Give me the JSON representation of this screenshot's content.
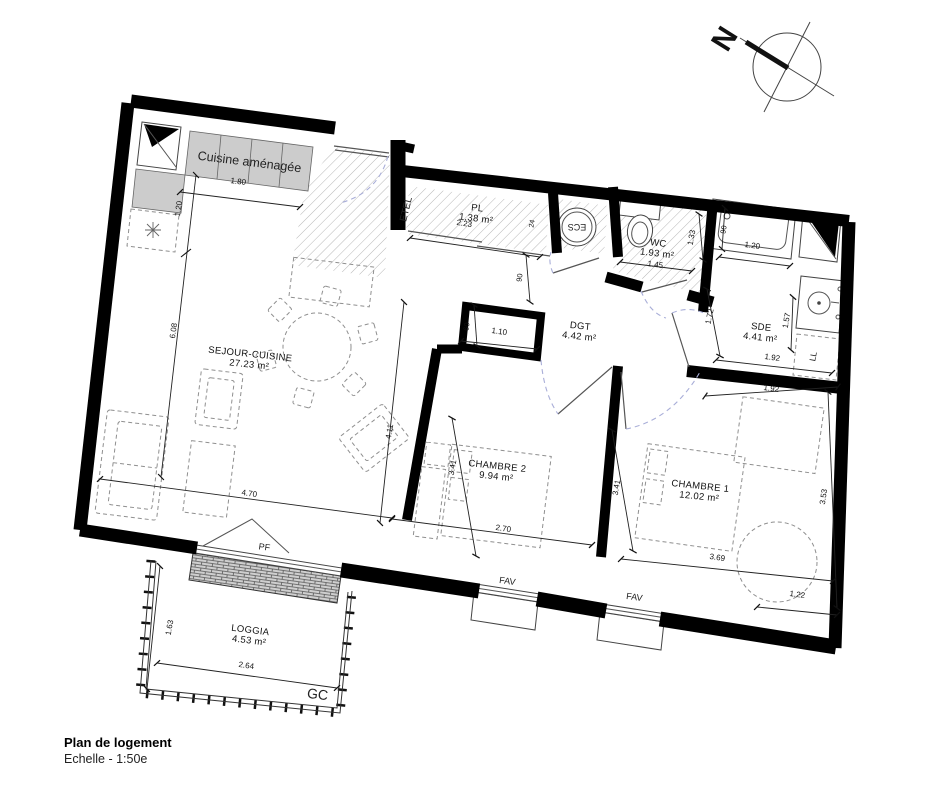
{
  "page": {
    "title": "Plan de logement",
    "scale": "Echelle - 1:50e"
  },
  "compass": {
    "north_label": "N"
  },
  "colors": {
    "wall": "#000000",
    "counter": "#cccccc",
    "hatch": "#9c9c9c",
    "furniture_dash": "#8f8f8f",
    "door_arc": "#a9aed8",
    "text": "#111111"
  },
  "rooms": [
    {
      "name": "SEJOUR-CUISINE",
      "area": "27.23 m²",
      "x": 250,
      "y": 357,
      "rot": 6
    },
    {
      "name": "CHAMBRE 2",
      "area": "9.94 m²",
      "x": 497,
      "y": 469,
      "rot": 6
    },
    {
      "name": "CHAMBRE 1",
      "area": "12.02 m²",
      "x": 700,
      "y": 489,
      "rot": 6
    },
    {
      "name": "DGT",
      "area": "4.42 m²",
      "x": 580,
      "y": 329,
      "rot": 6
    },
    {
      "name": "PL",
      "area": "1.38 m²",
      "x": 477,
      "y": 211,
      "rot": 7
    },
    {
      "name": "WC",
      "area": "1.93 m²",
      "x": 658,
      "y": 246,
      "rot": 7
    },
    {
      "name": "SDE",
      "area": "4.41 m²",
      "x": 761,
      "y": 330,
      "rot": 6
    },
    {
      "name": "LOGGIA",
      "area": "4.53 m²",
      "x": 250,
      "y": 633,
      "rot": 7
    }
  ],
  "annotations": [
    {
      "id": "kitchen-label",
      "text": "Cuisine aménagée",
      "x": 249,
      "y": 166,
      "rot": 7,
      "fs": 12.5
    },
    {
      "id": "etel-label",
      "text": "ETEL",
      "x": 409,
      "y": 210,
      "rot": -76,
      "fs": 10
    },
    {
      "id": "ecs-label",
      "text": "ECS",
      "x": 577,
      "y": 224,
      "rot": 180,
      "fs": 9
    },
    {
      "id": "pf-label",
      "text": "PF",
      "x": 264,
      "y": 550,
      "rot": 8,
      "fs": 9
    },
    {
      "id": "fav-label-1",
      "text": "FAV",
      "x": 507,
      "y": 584,
      "rot": 8,
      "fs": 9
    },
    {
      "id": "fav-label-2",
      "text": "FAV",
      "x": 634,
      "y": 600,
      "rot": 8,
      "fs": 9
    },
    {
      "id": "gc-label",
      "text": "GC",
      "x": 317,
      "y": 699,
      "rot": 7,
      "fs": 14
    },
    {
      "id": "ll-label",
      "text": "LL",
      "x": 816,
      "y": 357,
      "rot": -80,
      "fs": 8.5
    }
  ],
  "dimensions": [
    {
      "text": "1.80",
      "x": 238,
      "y": 184,
      "rot": 7
    },
    {
      "text": "1.20",
      "x": 181,
      "y": 209,
      "rot": -82
    },
    {
      "text": "6.08",
      "x": 176,
      "y": 331,
      "rot": -82
    },
    {
      "text": "4.70",
      "x": 249,
      "y": 496,
      "rot": 8
    },
    {
      "text": "4.11",
      "x": 392,
      "y": 432,
      "rot": -80
    },
    {
      "text": "2.23",
      "x": 464,
      "y": 226,
      "rot": 8
    },
    {
      "text": "24",
      "x": 534,
      "y": 224,
      "rot": -80,
      "fs": 7
    },
    {
      "text": "90",
      "x": 522,
      "y": 278,
      "rot": -82,
      "fs": 7.5
    },
    {
      "text": "60",
      "x": 469,
      "y": 327,
      "rot": -82,
      "fs": 7.5
    },
    {
      "text": "1.10",
      "x": 499,
      "y": 334,
      "rot": 8
    },
    {
      "text": "3.41",
      "x": 455,
      "y": 468,
      "rot": -80
    },
    {
      "text": "2.70",
      "x": 503,
      "y": 531,
      "rot": 8
    },
    {
      "text": "1.45",
      "x": 655,
      "y": 267,
      "rot": 8
    },
    {
      "text": "1.33",
      "x": 694,
      "y": 238,
      "rot": -80
    },
    {
      "text": "1.20",
      "x": 752,
      "y": 248,
      "rot": 8
    },
    {
      "text": "90",
      "x": 726,
      "y": 230,
      "rot": -80,
      "fs": 7.5
    },
    {
      "text": "1.72",
      "x": 712,
      "y": 317,
      "rot": -78
    },
    {
      "text": "1.57",
      "x": 789,
      "y": 321,
      "rot": -80
    },
    {
      "text": "1.92",
      "x": 772,
      "y": 360,
      "rot": 8
    },
    {
      "text": "1.92",
      "x": 771,
      "y": 391,
      "rot": 8
    },
    {
      "text": "3.41",
      "x": 619,
      "y": 488,
      "rot": -80
    },
    {
      "text": "3.53",
      "x": 826,
      "y": 497,
      "rot": -82
    },
    {
      "text": "3.69",
      "x": 717,
      "y": 560,
      "rot": 8
    },
    {
      "text": "1.22",
      "x": 797,
      "y": 597,
      "rot": 8
    },
    {
      "text": "1.63",
      "x": 172,
      "y": 628,
      "rot": -80
    },
    {
      "text": "2.64",
      "x": 246,
      "y": 668,
      "rot": 8
    }
  ]
}
